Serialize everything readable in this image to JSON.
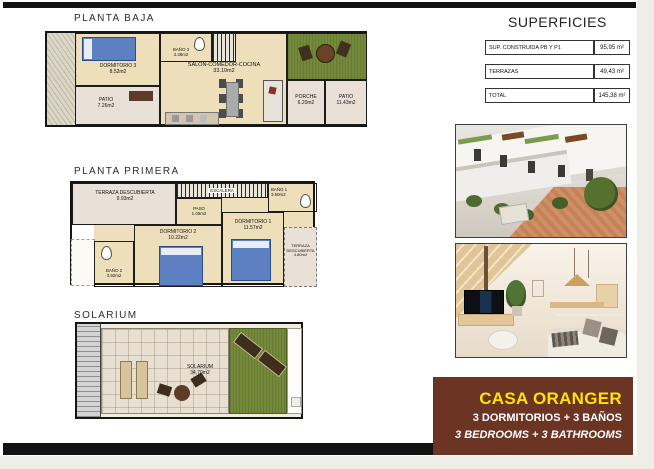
{
  "floors": {
    "planta_baja": {
      "title": "PLANTA BAJA",
      "rooms": {
        "dormitorio3": {
          "name": "DORMITORIO 3",
          "area": "8.52m2"
        },
        "bano3": {
          "name": "BAÑO 3",
          "area": "3.36m2"
        },
        "salon": {
          "name": "SALON-COMEDOR-COCINA",
          "area": "33.10m2"
        },
        "patio": {
          "name": "PATIO",
          "area": "7.26m2"
        },
        "porche": {
          "name": "PORCHE",
          "area": "6.20m2"
        },
        "patio_grande": {
          "name": "PATIO",
          "area": "11.43m2"
        }
      }
    },
    "planta_primera": {
      "title": "PLANTA PRIMERA",
      "rooms": {
        "terraza1": {
          "name": "TERRAZA DESCUBIERTA",
          "area": "9.93m2"
        },
        "escalera": {
          "name": "ESCALERA",
          "area": ""
        },
        "bano1": {
          "name": "BAÑO 1",
          "area": "3.60m2"
        },
        "paso": {
          "name": "PASO",
          "area": "1.05m2"
        },
        "dormitorio2": {
          "name": "DORMITORIO 2",
          "area": "10.22m2"
        },
        "dormitorio1": {
          "name": "DORMITORIO 1",
          "area": "11.57m2"
        },
        "bano2": {
          "name": "BAÑO 2",
          "area": "3.92m2"
        },
        "terraza2": {
          "name": "TERRAZA DESCUBIERTA",
          "area": "4.80m2"
        }
      }
    },
    "solarium": {
      "title": "SOLARIUM",
      "rooms": {
        "solarium": {
          "name": "SOLARIUM",
          "area": "34,70m2"
        }
      }
    }
  },
  "superficies": {
    "title": "SUPERFICIES",
    "rows": [
      {
        "label": "SUP. CONSTRUIDA PB Y P1",
        "value": "95,95 m²"
      },
      {
        "label": "TERRAZAS",
        "value": "49,43 m²"
      },
      {
        "label": "TOTAL",
        "value": "145,38 m²"
      }
    ]
  },
  "banner": {
    "title": "CASA ORANGER",
    "line_es": "3 DORMITORIOS + 3 BAÑOS",
    "line_en": "3 BEDROOMS + 3 BATHROOMS",
    "bg_color": "#6b3423",
    "title_color": "#ffe400",
    "text_color": "#ffffff"
  }
}
